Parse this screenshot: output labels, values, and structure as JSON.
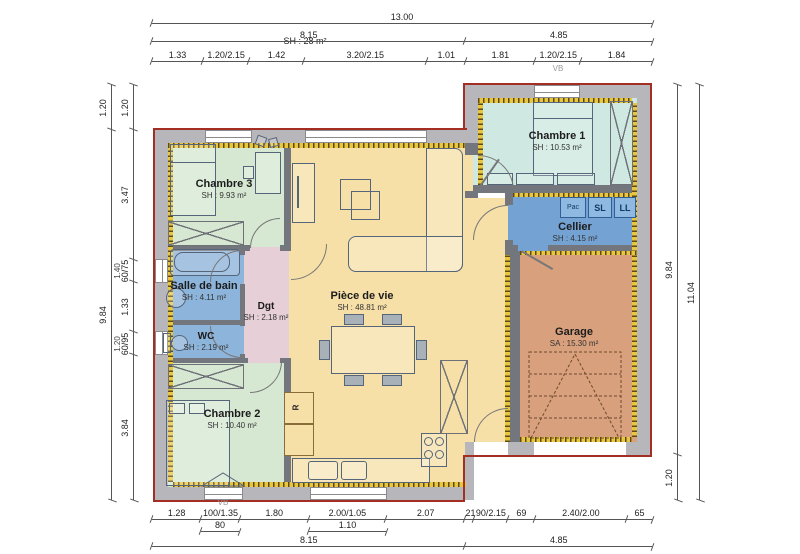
{
  "rooms": {
    "chambre3": {
      "name": "Chambre 3",
      "area": "SH : 9.93 m²"
    },
    "chambre1": {
      "name": "Chambre 1",
      "area": "SH : 10.53 m²"
    },
    "chambre2": {
      "name": "Chambre 2",
      "area": "SH : 10.40 m²"
    },
    "salle_de_bain": {
      "name": "Salle de bain",
      "area": "SH : 4.11 m²"
    },
    "wc": {
      "name": "WC",
      "area": "SH : 2.19 m²"
    },
    "dgt": {
      "name": "Dgt",
      "area": "SH : 2.18 m²"
    },
    "piece_de_vie": {
      "name": "Pièce de vie",
      "area": "SH : 48.81 m²"
    },
    "cellier": {
      "name": "Cellier",
      "area": "SH : 4.15 m²"
    },
    "garage": {
      "name": "Garage",
      "area": "SA : 15.30 m²"
    }
  },
  "appliances": {
    "pac": "Pac",
    "sl": "SL",
    "ll": "LL",
    "fridge": "R"
  },
  "annotations": {
    "sh_total": "SH : 28 m²",
    "vb_top": "VB",
    "vb_bottom": "VB"
  },
  "dimensions": {
    "top_total": "13.00",
    "top_sections": [
      "8.15",
      "4.85"
    ],
    "top_details": [
      "1.33",
      "1.20/2.15",
      "1.42",
      "3.20/2.15",
      "1.01",
      "1.81",
      "1.20/2.15",
      "1.84"
    ],
    "bottom_details": [
      "1.28",
      "100/1.35",
      "1.80",
      "2.00/1.05",
      "2.07",
      "21",
      "90/2.15",
      "69",
      "2.40/2.00",
      "65"
    ],
    "bottom_subs": [
      "80",
      "1.10"
    ],
    "bottom_sections": [
      "8.15",
      "4.85"
    ],
    "left_outer": [
      "1.20",
      "9.84"
    ],
    "left_inner": [
      "1.20",
      "3.47",
      "60/75",
      "1.33",
      "60/95",
      "3.84"
    ],
    "left_inner_subs": [
      "1.40",
      "1.20"
    ],
    "right_inner": [
      "9.84",
      "1.20"
    ],
    "right_outer": "11.04"
  },
  "colors": {
    "exterior_wall": "#b7b7bb",
    "partition": "#73767d",
    "outline_red": "#a32e24",
    "insulation": "#e9c640",
    "bedroom_green": "#d6e8d2",
    "bedroom1_teal": "#cfe8e1",
    "bath_blue": "#8db4da",
    "cellier_blue": "#74a3d3",
    "hall_pink": "#e6cfd7",
    "living_yellow": "#f6e0a8",
    "garage_orange": "#d8a07c"
  }
}
